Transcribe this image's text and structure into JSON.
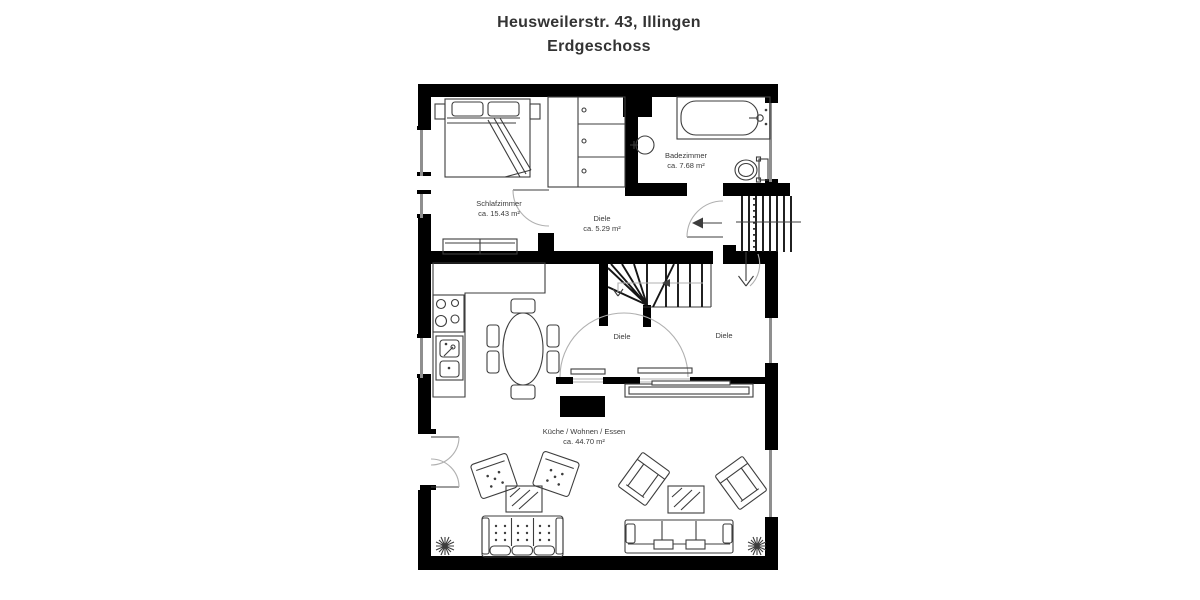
{
  "title": {
    "line1": "Heusweilerstr. 43, Illingen",
    "line2": "Erdgeschoss"
  },
  "rooms": {
    "schlafzimmer": {
      "name": "Schlafzimmer",
      "area": "ca. 15.43 m²"
    },
    "badezimmer": {
      "name": "Badezimmer",
      "area": "ca. 7.68 m²"
    },
    "diele": {
      "name": "Diele",
      "area": "ca. 5.29 m²"
    },
    "diele_left": {
      "name": "Diele"
    },
    "diele_right": {
      "name": "Diele"
    },
    "wohnen": {
      "name": "Küche / Wohnen / Essen",
      "area": "ca. 44.70 m²"
    }
  },
  "colors": {
    "background": "#ffffff",
    "wall": "#000000",
    "line": "#3d3d3d",
    "light_line": "#b0b0b0",
    "text": "#3a3a3a",
    "title_text": "#333333",
    "window": "#8f8f8f"
  }
}
